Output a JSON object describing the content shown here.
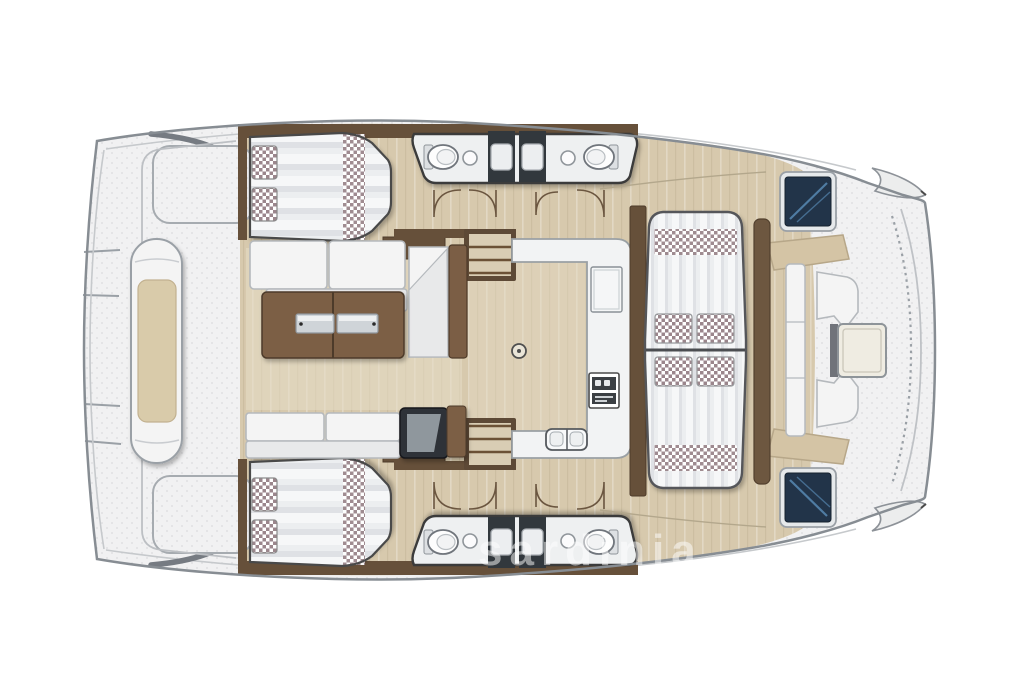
{
  "watermark": {
    "text": "sardinia"
  },
  "colors": {
    "deck": "#f1f1f2",
    "speck": "#dcdcde",
    "floor": "#d7c9ad",
    "floor_light": "#e6dcc6",
    "wall": "#66503a",
    "wood": "#7b5e45",
    "wood_dark": "#4e3b2a",
    "cushion": "#f4f4f4",
    "cushion_line": "#b5b9bd",
    "cushion_shade": "#e8e9ea",
    "stripe": "#dfe1e5",
    "stripe_light": "#f6f7f8",
    "checker": "#9b868c",
    "tan": "#d4c4a5",
    "navy": "#223449",
    "streak": "#4f7ca3",
    "shower": "#33383d",
    "cabinet": "#2f3338",
    "cabinet_inner": "#9aa2a9",
    "metal": "#cfd4d8",
    "white": "#ffffff",
    "outline": "#8b9197"
  },
  "areas": [
    "hull-outline",
    "foredeck",
    "deck-lounger",
    "cabin-bed-port",
    "cabin-bed-starboard",
    "bathroom-port",
    "bathroom-starboard",
    "toilet",
    "sink",
    "shower",
    "saloon-sofa",
    "coffee-table",
    "storage-cabinet",
    "companionway-steps",
    "galley-counter",
    "fridge",
    "stove",
    "double-sink",
    "cockpit-daybed",
    "side-table",
    "cockpit-sofa",
    "cockpit-table",
    "deck-hatch",
    "coaming",
    "bow-tip",
    "door-swing"
  ]
}
